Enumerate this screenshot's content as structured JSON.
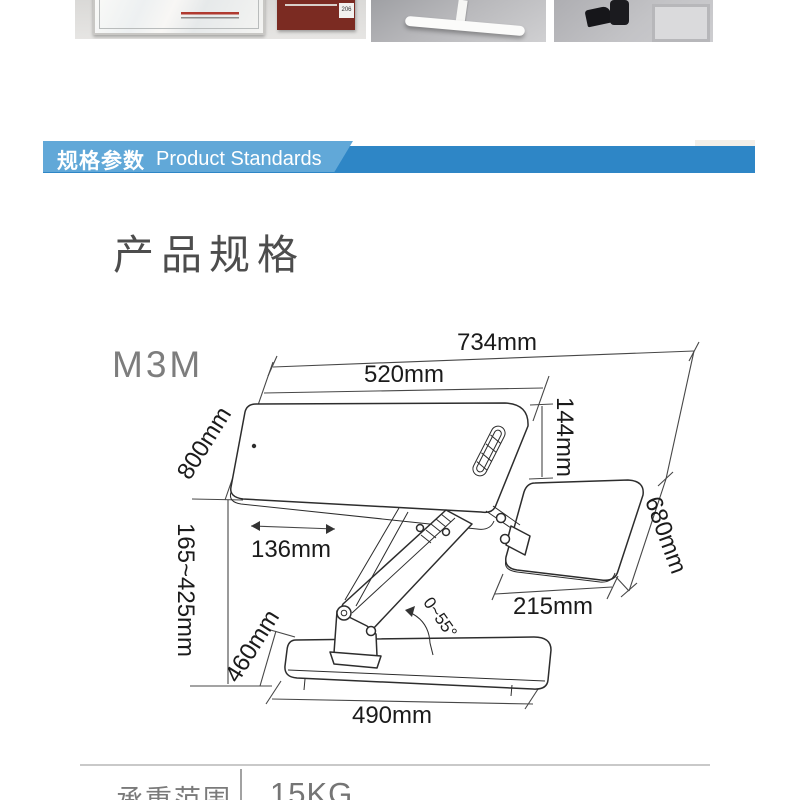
{
  "photos": {
    "door_sign_number": "206"
  },
  "banner": {
    "title_cn": "规格参数",
    "title_en": "Product Standards"
  },
  "section": {
    "heading": "产品规格"
  },
  "diagram": {
    "model": "M3M",
    "dims": {
      "overall_width": "734mm",
      "surface_width": "520mm",
      "surface_depth": "800mm",
      "tray_drop": "144mm",
      "height_range": "165~425mm",
      "surface_offset": "136mm",
      "tray_depth": "680mm",
      "tray_width": "215mm",
      "base_depth": "460mm",
      "base_width": "490mm",
      "tilt_range": "0~55°"
    }
  },
  "specs": {
    "rows": [
      {
        "label": "承重范围",
        "value": "15KG"
      }
    ]
  }
}
